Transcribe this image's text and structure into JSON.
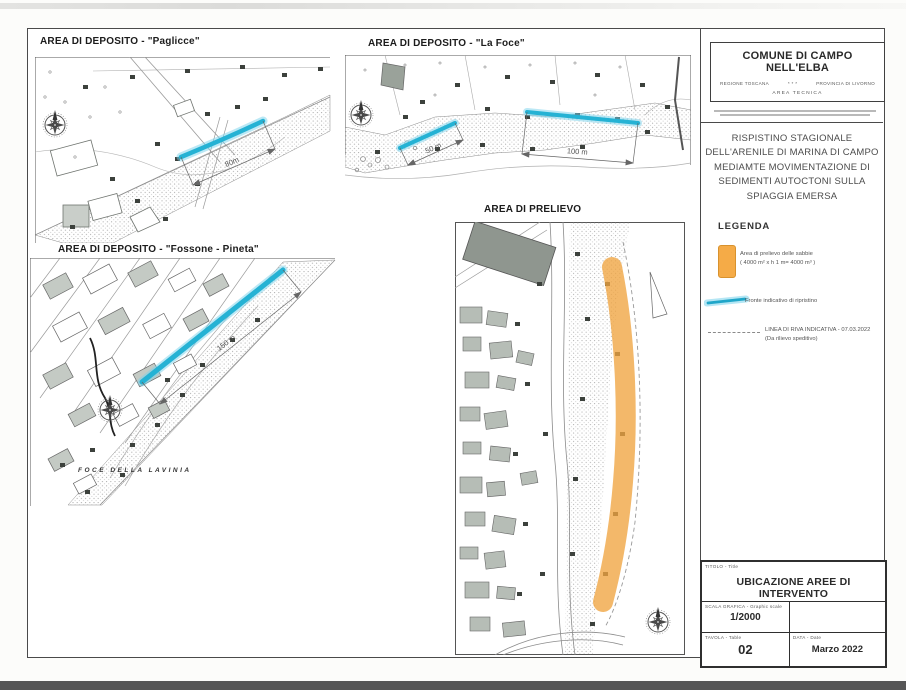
{
  "panels": {
    "paglicce": {
      "title": "AREA DI DEPOSITO - \"Paglicce\"",
      "dimension": "80m"
    },
    "la_foce": {
      "title": "AREA DI DEPOSITO - \"La Foce\"",
      "dim_50": "50 m",
      "dim_100": "100 m"
    },
    "fossone": {
      "title": "AREA DI DEPOSITO - \"Fossone - Pineta\"",
      "dimension": "150 m",
      "place_label": "FOCE DELLA LAVINIA"
    },
    "prelievo": {
      "title": "AREA DI PRELIEVO"
    }
  },
  "header": {
    "municipality": "COMUNE DI CAMPO NELL'ELBA",
    "region": "REGIONE TOSCANA",
    "separator": "* * *",
    "province": "PROVINCIA DI LIVORNO",
    "office": "AREA TECNICA"
  },
  "project": {
    "title_lines": [
      "RISPISTINO STAGIONALE",
      "DELL'ARENILE DI MARINA DI CAMPO",
      "MEDIAMTE MOVIMENTAZIONE DI",
      "SEDIMENTI AUTOCTONI SULLA",
      "SPIAGGIA EMERSA"
    ]
  },
  "legend": {
    "heading": "LEGENDA",
    "extraction_line1": "Area di prelievo delle sabbie",
    "extraction_line2": "( 4000 m² x h 1 m= 4000 m³ )",
    "front_label": "Fronte indicativo di ripristino",
    "shoreline_line1": "LINEA DI RIVA INDICATIVA - 07.03.2022",
    "shoreline_line2": "(Da rilievo speditivo)"
  },
  "title_block": {
    "title_label": "TITOLO - Title",
    "title_value": "UBICAZIONE AREE DI INTERVENTO",
    "scale_label": "SCALA GRAFICA - Graphic scale",
    "scale_value": "1/2000",
    "sheet_label": "TAVOLA - Table",
    "sheet_value": "02",
    "date_label": "DATA - Date",
    "date_value": "Marzo 2022"
  },
  "colors": {
    "restore_front": "#25b2d4",
    "extraction_area": "#f0a440"
  }
}
